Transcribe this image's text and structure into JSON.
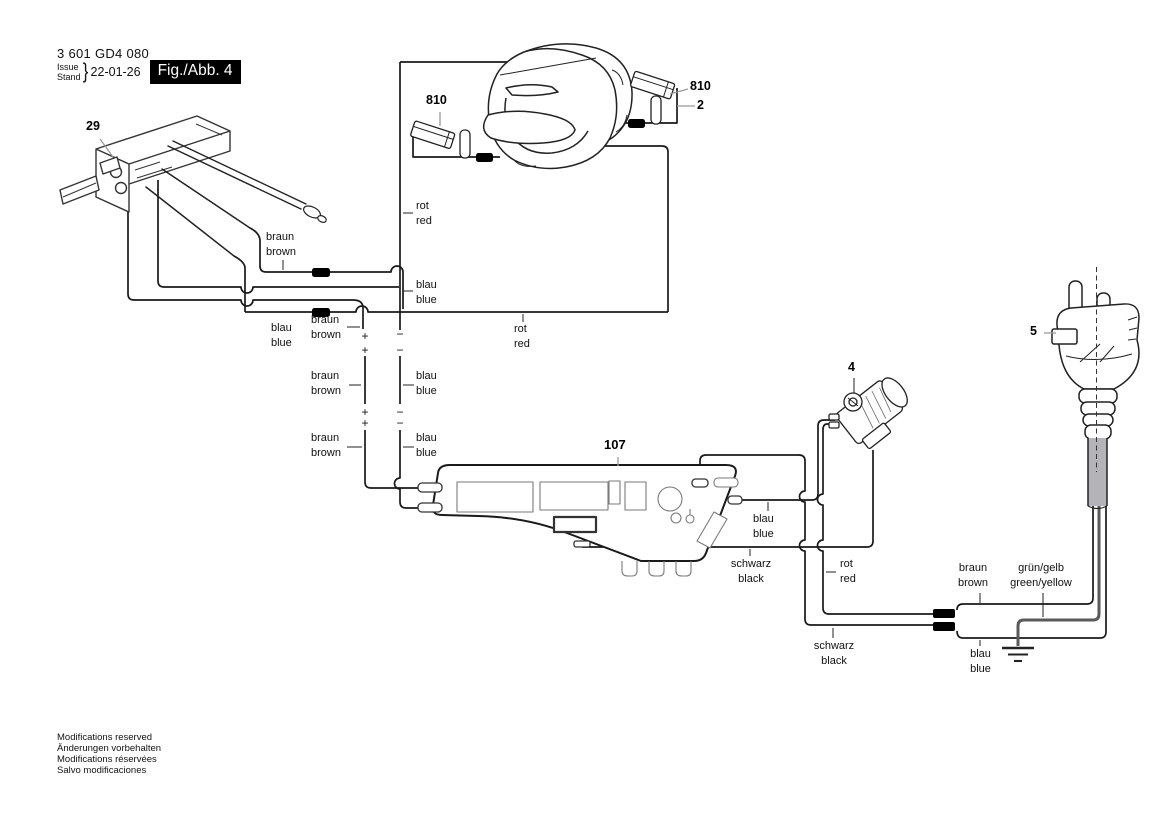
{
  "header": {
    "part_number": "3 601 GD4 080",
    "issue_label": "Issue",
    "stand_label": "Stand",
    "date": "22-01-26",
    "figure_label": "Fig./Abb. 4"
  },
  "callouts": {
    "switch": "29",
    "brush_left": "810",
    "brush_right": "810",
    "field_coil": "2",
    "plug": "5",
    "suppressor": "4",
    "module": "107"
  },
  "wire_labels": [
    {
      "de": "rot",
      "en": "red"
    },
    {
      "de": "braun",
      "en": "brown"
    },
    {
      "de": "blau",
      "en": "blue"
    },
    {
      "de": "blau",
      "en": "blue"
    },
    {
      "de": "braun",
      "en": "brown"
    },
    {
      "de": "rot",
      "en": "red"
    },
    {
      "de": "braun",
      "en": "brown"
    },
    {
      "de": "blau",
      "en": "blue"
    },
    {
      "de": "braun",
      "en": "brown"
    },
    {
      "de": "blau",
      "en": "blue"
    },
    {
      "de": "blau",
      "en": "blue"
    },
    {
      "de": "schwarz",
      "en": "black"
    },
    {
      "de": "rot",
      "en": "red"
    },
    {
      "de": "schwarz",
      "en": "black"
    },
    {
      "de": "braun",
      "en": "brown"
    },
    {
      "de": "grün/gelb",
      "en": "green/yellow"
    },
    {
      "de": "blau",
      "en": "blue"
    }
  ],
  "polarity": {
    "plus": "+",
    "minus": "−"
  },
  "footer": {
    "lines": [
      "Modifications reserved",
      "Änderungen vorbehalten",
      "Modifications réservées",
      "Salvo modificaciones"
    ]
  },
  "colors": {
    "wire": "#1a1a1a",
    "ground_wire": "#5a5a5a",
    "connector_block": "#000000",
    "figure_box_bg": "#000000",
    "figure_box_text": "#ffffff",
    "pointer_line": "#999999"
  }
}
